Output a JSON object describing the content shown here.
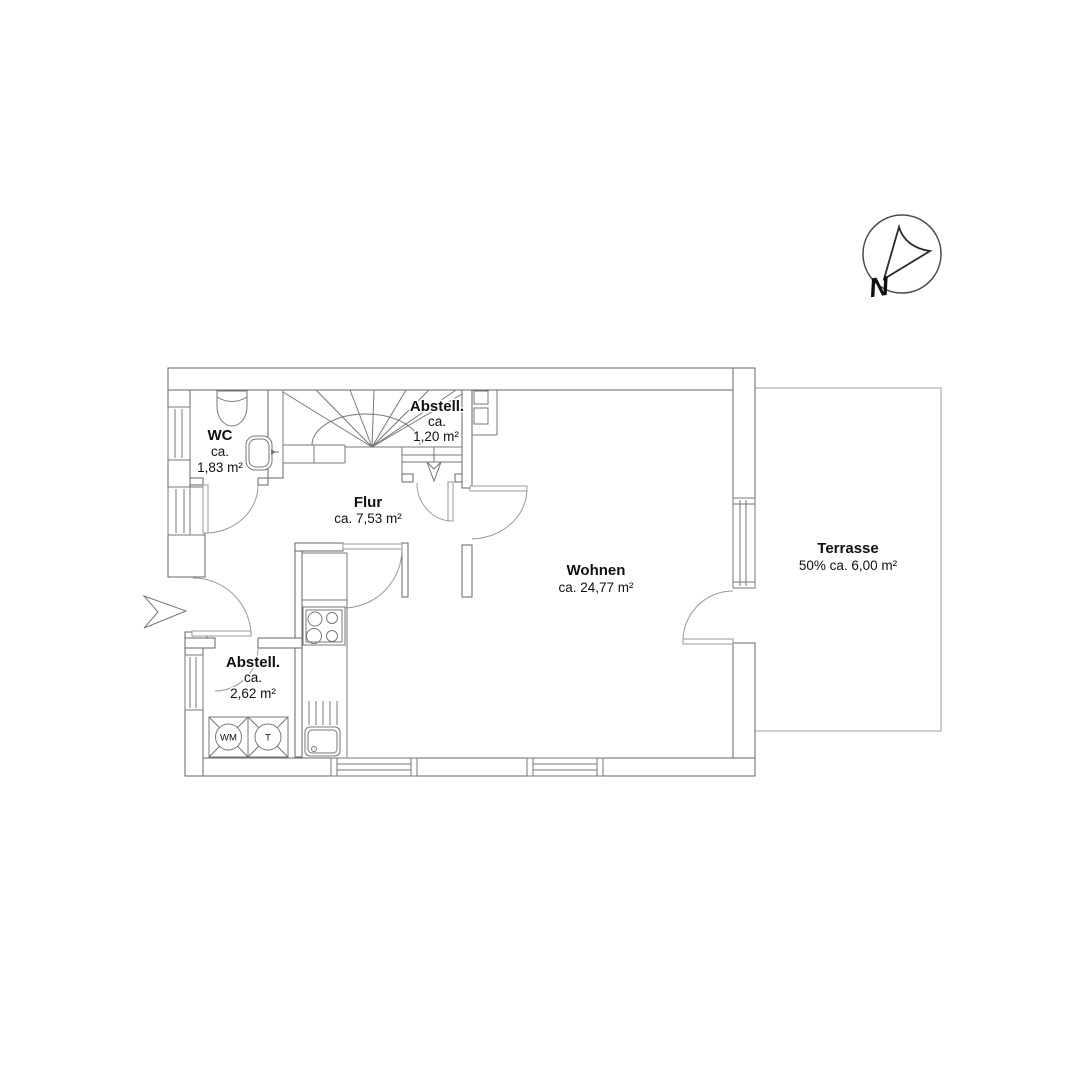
{
  "rooms": {
    "wc": {
      "name": "WC",
      "ca": "ca.",
      "area": "1,83 m²"
    },
    "abstell_upper": {
      "name": "Abstell.",
      "ca": "ca.",
      "area": "1,20 m²"
    },
    "flur": {
      "name": "Flur",
      "area": "ca. 7,53 m²"
    },
    "wohnen": {
      "name": "Wohnen",
      "area": "ca. 24,77 m²"
    },
    "abstell_lower": {
      "name": "Abstell.",
      "ca": "ca.",
      "area": "2,62 m²"
    },
    "terrasse": {
      "name": "Terrasse",
      "area": "50% ca. 6,00 m²"
    }
  },
  "appliances": {
    "washing_machine_label": "WM",
    "dryer_label": "T"
  },
  "compass": {
    "north_label": "N"
  },
  "colors": {
    "wall_line": "#666666",
    "fixture_line": "#777777",
    "door_line": "#9a9a9a",
    "text": "#111111",
    "background": "#ffffff"
  }
}
